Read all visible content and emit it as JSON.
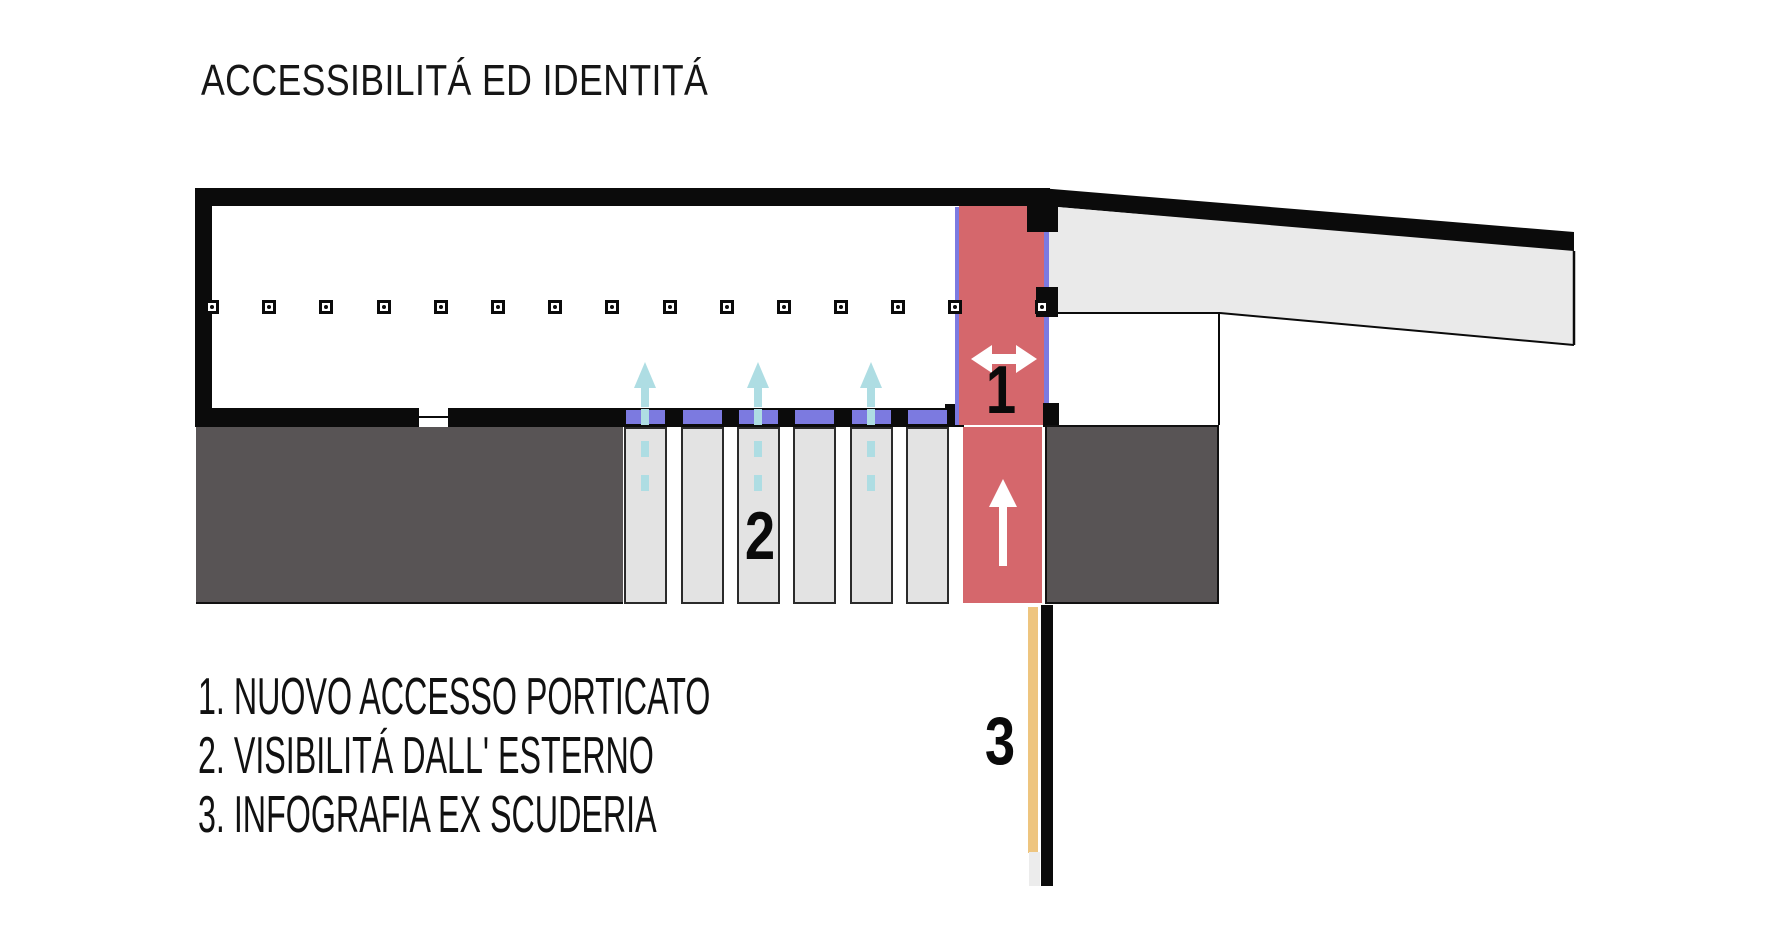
{
  "title": "ACCESSIBILITÁ ED IDENTITÁ",
  "legend": [
    "1. NUOVO ACCESSO PORTICATO",
    "2. VISIBILITÁ DALL' ESTERNO",
    "3. INFOGRAFIA EX SCUDERIA"
  ],
  "plan": {
    "markers": {
      "access": "1",
      "visibility": "2",
      "infographic": "3"
    },
    "colors": {
      "wall": "#0b0b0b",
      "accent_red": "#d5676c",
      "window_purple": "#7c7ae0",
      "flow_teal": "#aedde3",
      "block_gray": "#585455",
      "pier_gray": "#e3e3e3",
      "wing_gray": "#eaeaea",
      "info_yellow": "#eec57f"
    },
    "columns_x": [
      212,
      269,
      326,
      384,
      441,
      498,
      555,
      612,
      670,
      727,
      784,
      841,
      898,
      955,
      1042
    ],
    "bays_x": [
      624,
      681,
      737,
      793,
      850,
      906
    ],
    "flow_arrows_x": [
      645,
      758,
      871
    ],
    "dash_y": [
      409,
      441,
      475
    ]
  }
}
